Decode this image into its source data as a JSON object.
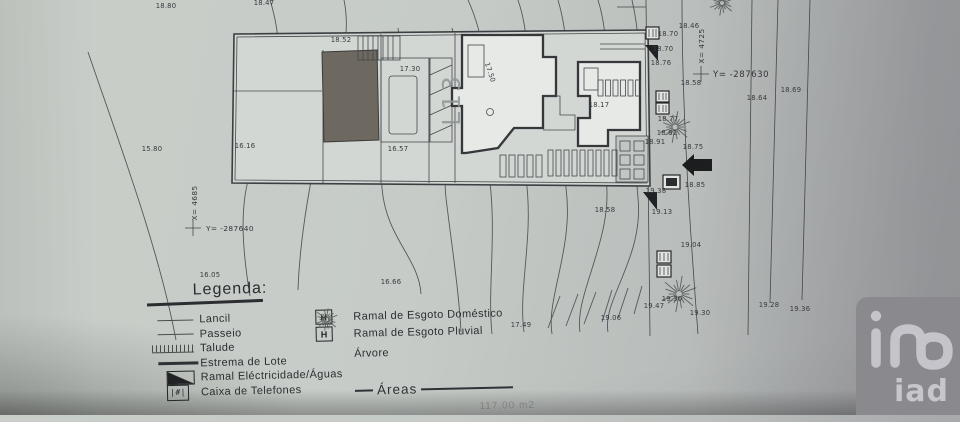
{
  "survey": {
    "lot_number": "L13",
    "left_station": {
      "x_label": "X= 4685",
      "y_label": "Y= -287640"
    },
    "right_station": {
      "x_label": "X= 4725",
      "y_label": "Y= -287630"
    }
  },
  "plan": {
    "spot_labels": [
      {
        "text": "18.80",
        "x": 166,
        "y": 8
      },
      {
        "text": "18.47",
        "x": 264,
        "y": 5
      },
      {
        "text": "18.52",
        "x": 341,
        "y": 42
      },
      {
        "text": "17.30",
        "x": 410,
        "y": 71
      },
      {
        "text": "17.50",
        "x": 488,
        "y": 73,
        "rot": 72
      },
      {
        "text": "16.16",
        "x": 245,
        "y": 148
      },
      {
        "text": "15.80",
        "x": 152,
        "y": 151
      },
      {
        "text": "16.57",
        "x": 398,
        "y": 151
      },
      {
        "text": "18.17",
        "x": 599,
        "y": 107
      },
      {
        "text": "16.05",
        "x": 210,
        "y": 277
      },
      {
        "text": "16.66",
        "x": 391,
        "y": 284
      },
      {
        "text": "17.49",
        "x": 521,
        "y": 327
      },
      {
        "text": "19.06",
        "x": 611,
        "y": 320
      },
      {
        "text": "18.58",
        "x": 605,
        "y": 212
      },
      {
        "text": "18.70",
        "x": 668,
        "y": 36
      },
      {
        "text": "18.70",
        "x": 663,
        "y": 51
      },
      {
        "text": "18.76",
        "x": 661,
        "y": 65
      },
      {
        "text": "18.46",
        "x": 689,
        "y": 28
      },
      {
        "text": "18.58",
        "x": 691,
        "y": 85
      },
      {
        "text": "18.64",
        "x": 757,
        "y": 100
      },
      {
        "text": "18.69",
        "x": 791,
        "y": 92
      },
      {
        "text": "18.77",
        "x": 668,
        "y": 121
      },
      {
        "text": "18.82",
        "x": 667,
        "y": 135
      },
      {
        "text": "18.91",
        "x": 655,
        "y": 144
      },
      {
        "text": "18.75",
        "x": 693,
        "y": 149
      },
      {
        "text": "18.85",
        "x": 695,
        "y": 187
      },
      {
        "text": "19.38",
        "x": 656,
        "y": 193
      },
      {
        "text": "19.13",
        "x": 662,
        "y": 214
      },
      {
        "text": "19.04",
        "x": 691,
        "y": 247
      },
      {
        "text": "19.47",
        "x": 654,
        "y": 308
      },
      {
        "text": "19.30",
        "x": 672,
        "y": 301
      },
      {
        "text": "19.30",
        "x": 700,
        "y": 315
      },
      {
        "text": "19.28",
        "x": 769,
        "y": 307
      },
      {
        "text": "19.36",
        "x": 800,
        "y": 311
      }
    ]
  },
  "legend": {
    "title": "Legenda:",
    "left_items": [
      {
        "icon": "thin-line",
        "label": "Lancil"
      },
      {
        "icon": "thin-line",
        "label": "Passeio"
      },
      {
        "icon": "hatched-line",
        "label": "Talude"
      },
      {
        "icon": "thick-line",
        "label": "Estrema de Lote"
      },
      {
        "icon": "half-filled-box",
        "label": "Ramal Eléctricidade/Águas"
      },
      {
        "icon": "telephone-box",
        "label": "Caixa de Telefones"
      }
    ],
    "right_items": [
      {
        "icon": "box-h",
        "label": "Ramal de Esgoto Doméstico"
      },
      {
        "icon": "box-h",
        "label": "Ramal de Esgoto Pluvial"
      },
      {
        "icon": "tree-starburst",
        "label": "Árvore"
      }
    ],
    "areas_heading": "Áreas",
    "areas_value_partial": "117.00 m2"
  },
  "logo": {
    "wordmark": "iad",
    "bg_color": "#8a8a8e",
    "fg_color": "#c6c6cc"
  },
  "colors": {
    "paper": "#c6cbc7",
    "ink": "#383a3e",
    "building_fill": "#6e6960",
    "lot_fill": "#d3d7d3"
  }
}
